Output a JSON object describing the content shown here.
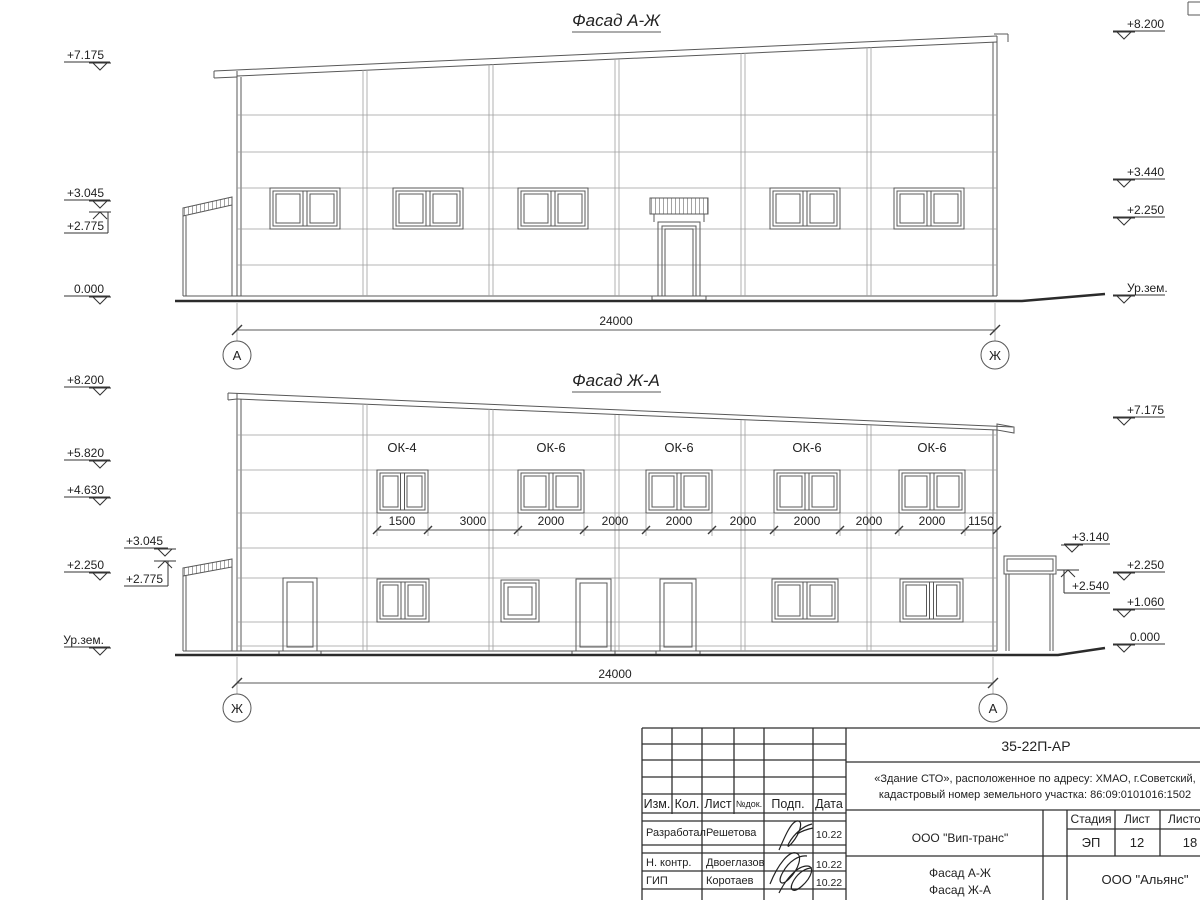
{
  "sheet": {
    "facade1": {
      "title": "Фасад А-Ж",
      "marks_left": [
        "+7.175",
        "+3.045",
        "+2.775",
        "0.000"
      ],
      "marks_right": [
        "+8.200",
        "+3.440",
        "+2.250",
        "Ур.зем."
      ],
      "total_dim": "24000",
      "axis_left": "А",
      "axis_right": "Ж"
    },
    "facade2": {
      "title": "Фасад Ж-А",
      "marks_left": [
        "+8.200",
        "+5.820",
        "+4.630",
        "+3.045",
        "+2.250",
        "+2.775",
        "Ур.зем."
      ],
      "marks_right": [
        "+7.175",
        "+3.140",
        "+2.540",
        "+2.250",
        "+1.060",
        "0.000"
      ],
      "window_labels": [
        "ОК-4",
        "ОК-6",
        "ОК-6",
        "ОК-6",
        "ОК-6"
      ],
      "dims": [
        "1500",
        "3000",
        "2000",
        "2000",
        "2000",
        "2000",
        "2000",
        "2000",
        "2000",
        "1150"
      ],
      "total_dim": "24000",
      "axis_left": "Ж",
      "axis_right": "А"
    },
    "titleblock": {
      "doc_number": "35-22П-АР",
      "project_line1": "«Здание СТО», расположенное по адресу: ХМАО, г.Советский,",
      "project_line2": "кадастровый номер земельного участка: 86:09:0101016:1502",
      "cols": {
        "izm": "Изм.",
        "kol": "Кол.",
        "list": "Лист",
        "ndok": "№док.",
        "podp": "Подп.",
        "data": "Дата"
      },
      "rows": [
        {
          "role": "Разработал",
          "name": "Решетова",
          "date": "10.22"
        },
        {
          "role": "Н. контр.",
          "name": "Двоеглазов",
          "date": "10.22"
        },
        {
          "role": "ГИП",
          "name": "Коротаев",
          "date": "10.22"
        }
      ],
      "company": "ООО \"Вип-транс\"",
      "stage_label": "Стадия",
      "sheet_label": "Лист",
      "sheets_label": "Листов",
      "stage_value": "ЭП",
      "sheet_value": "12",
      "sheets_value": "18",
      "title_line1": "Фасад А-Ж",
      "title_line2": "Фасад Ж-А",
      "org": "ООО \"Альянс\""
    }
  }
}
